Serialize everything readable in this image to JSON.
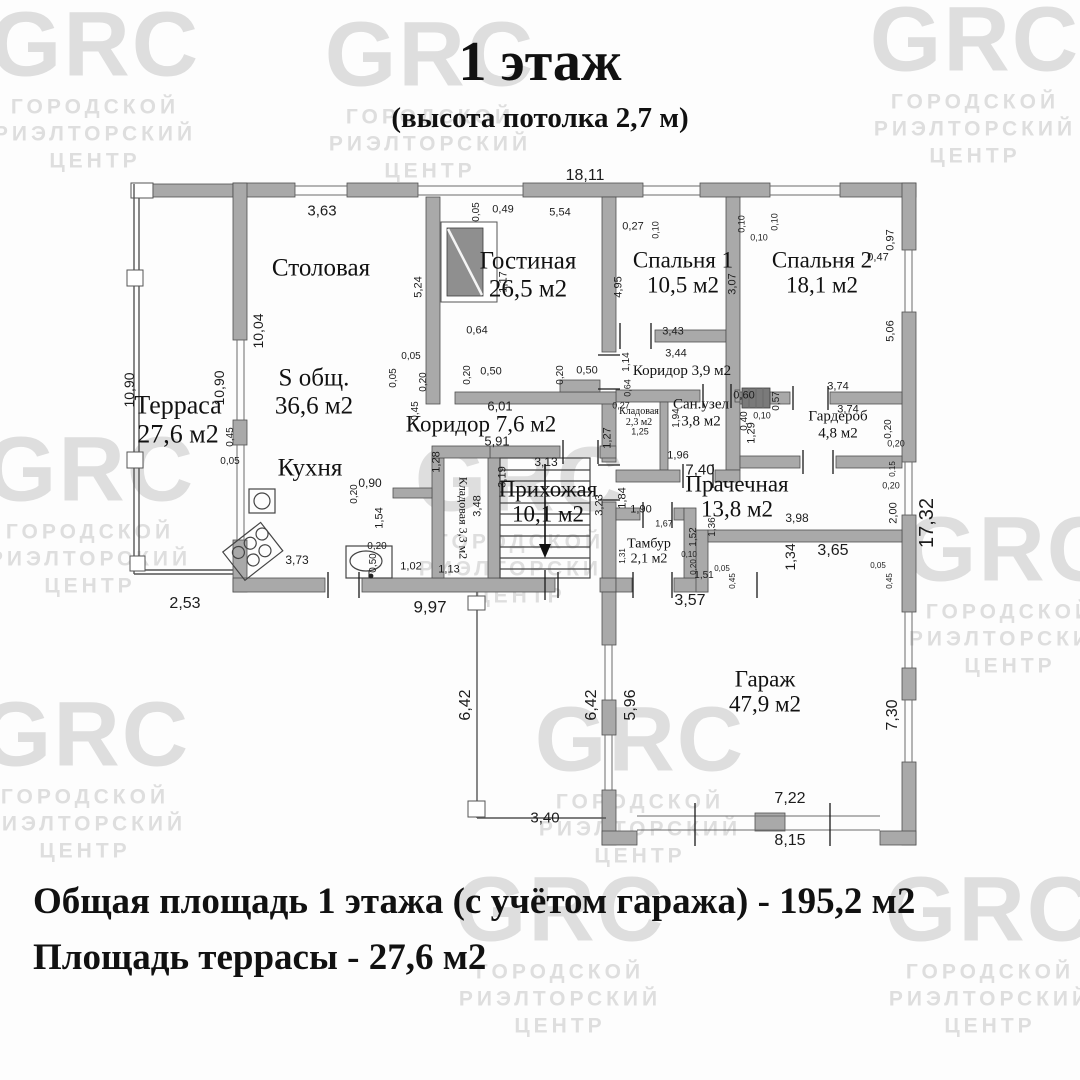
{
  "header": {
    "title": "1 этаж",
    "subtitle": "(высота потолка 2,7 м)"
  },
  "footer": {
    "line1": "Общая площадь 1 этажа (с учётом гаража) - 195,2 м2",
    "line2": "Площадь террасы - 27,6 м2"
  },
  "watermark": {
    "brand": "GRC",
    "lines": [
      "ГОРОДСКОЙ",
      "РИЭЛТОРСКИЙ",
      "ЦЕНТР"
    ],
    "positions": [
      {
        "x": 95,
        "y": 85
      },
      {
        "x": 975,
        "y": 80
      },
      {
        "x": 430,
        "y": 95
      },
      {
        "x": 90,
        "y": 510
      },
      {
        "x": 520,
        "y": 520
      },
      {
        "x": 1010,
        "y": 590
      },
      {
        "x": 85,
        "y": 775
      },
      {
        "x": 640,
        "y": 780
      },
      {
        "x": 560,
        "y": 950
      },
      {
        "x": 990,
        "y": 950
      }
    ]
  },
  "colors": {
    "wall": "#a9a9a9",
    "shaft": "#7a7a7a",
    "watermark": "#dedede",
    "ink": "#111111"
  },
  "plan": {
    "rooms": [
      {
        "name": "Терраса",
        "area": "27,6 м2",
        "x": 178,
        "y": 420,
        "fs": 26
      },
      {
        "name": "Столовая",
        "area": "",
        "x": 321,
        "y": 268,
        "fs": 25
      },
      {
        "name": "S общ.",
        "area": "36,6 м2",
        "x": 314,
        "y": 392,
        "fs": 25
      },
      {
        "name": "Гостиная",
        "area": "26,5 м2",
        "x": 528,
        "y": 275,
        "fs": 25
      },
      {
        "name": "Спальня 1",
        "area": "10,5 м2",
        "x": 683,
        "y": 273,
        "fs": 23
      },
      {
        "name": "Спальня 2",
        "area": "18,1 м2",
        "x": 822,
        "y": 273,
        "fs": 23
      },
      {
        "name": "Коридор 3,9 м2",
        "area": "",
        "x": 682,
        "y": 371,
        "fs": 15
      },
      {
        "name": "Сан.узел",
        "area": "3,8 м2",
        "x": 701,
        "y": 413,
        "fs": 15
      },
      {
        "name": "Кладовая",
        "area": "2,3 м2",
        "x": 639,
        "y": 417,
        "fs": 10
      },
      {
        "name": "Гардероб",
        "area": "4,8 м2",
        "x": 838,
        "y": 425,
        "fs": 15
      },
      {
        "name": "Коридор 7,6 м2",
        "area": "",
        "x": 481,
        "y": 424,
        "fs": 23
      },
      {
        "name": "Кухня",
        "area": "",
        "x": 310,
        "y": 468,
        "fs": 25
      },
      {
        "name": "Кладовая 3,3 м2",
        "area": "",
        "x": 463,
        "y": 518,
        "fs": 12,
        "rot": 90
      },
      {
        "name": "Прихожая",
        "area": "10,1 м2",
        "x": 548,
        "y": 502,
        "fs": 23
      },
      {
        "name": "Прачечная",
        "area": "13,8 м2",
        "x": 737,
        "y": 497,
        "fs": 23
      },
      {
        "name": "Тамбур",
        "area": "2,1 м2",
        "x": 649,
        "y": 552,
        "fs": 14
      },
      {
        "name": "Гараж",
        "area": "47,9 м2",
        "x": 765,
        "y": 692,
        "fs": 23
      }
    ],
    "dimensions": [
      {
        "t": "18,11",
        "x": 585,
        "y": 176,
        "s": 16
      },
      {
        "t": "3,63",
        "x": 322,
        "y": 211,
        "s": 15
      },
      {
        "t": "0,05",
        "x": 477,
        "y": 212,
        "r": 1,
        "s": 10
      },
      {
        "t": "0,49",
        "x": 503,
        "y": 210,
        "s": 11
      },
      {
        "t": "5,54",
        "x": 560,
        "y": 213,
        "s": 11
      },
      {
        "t": "0,27",
        "x": 633,
        "y": 227,
        "s": 11
      },
      {
        "t": "0,10",
        "x": 656,
        "y": 230,
        "r": 1,
        "s": 9
      },
      {
        "t": "0,10",
        "x": 742,
        "y": 224,
        "r": 1,
        "s": 9
      },
      {
        "t": "0,10",
        "x": 759,
        "y": 238,
        "s": 9
      },
      {
        "t": "0,10",
        "x": 775,
        "y": 222,
        "r": 1,
        "s": 9
      },
      {
        "t": "0,97",
        "x": 891,
        "y": 240,
        "r": 1,
        "s": 11
      },
      {
        "t": "0,47",
        "x": 878,
        "y": 258,
        "s": 11
      },
      {
        "t": "3,07",
        "x": 733,
        "y": 284,
        "r": 1,
        "s": 11
      },
      {
        "t": "5,06",
        "x": 891,
        "y": 331,
        "r": 1,
        "s": 11
      },
      {
        "t": "4,95",
        "x": 619,
        "y": 287,
        "r": 1,
        "s": 11
      },
      {
        "t": "5,24",
        "x": 419,
        "y": 287,
        "r": 1,
        "s": 11
      },
      {
        "t": "1,17",
        "x": 504,
        "y": 282,
        "r": 1,
        "s": 11
      },
      {
        "t": "0,64",
        "x": 477,
        "y": 331,
        "s": 11
      },
      {
        "t": "10,04",
        "x": 258,
        "y": 331,
        "r": 1,
        "s": 14
      },
      {
        "t": "10,90",
        "x": 219,
        "y": 388,
        "r": 1,
        "s": 14
      },
      {
        "t": "10,90",
        "x": 129,
        "y": 390,
        "r": 1,
        "s": 14
      },
      {
        "t": "0,05",
        "x": 411,
        "y": 357,
        "s": 10
      },
      {
        "t": "0,05",
        "x": 394,
        "y": 378,
        "r": 1,
        "s": 10
      },
      {
        "t": "0,20",
        "x": 424,
        "y": 382,
        "r": 1,
        "s": 10
      },
      {
        "t": "0,45",
        "x": 416,
        "y": 411,
        "r": 1,
        "s": 10
      },
      {
        "t": "0,20",
        "x": 468,
        "y": 375,
        "r": 1,
        "s": 10
      },
      {
        "t": "0,50",
        "x": 491,
        "y": 372,
        "s": 11
      },
      {
        "t": "0,20",
        "x": 561,
        "y": 375,
        "r": 1,
        "s": 10
      },
      {
        "t": "0,50",
        "x": 587,
        "y": 371,
        "s": 11
      },
      {
        "t": "0,45",
        "x": 231,
        "y": 437,
        "r": 1,
        "s": 10
      },
      {
        "t": "0,05",
        "x": 230,
        "y": 462,
        "s": 10
      },
      {
        "t": "6,01",
        "x": 500,
        "y": 406,
        "s": 13
      },
      {
        "t": "5,91",
        "x": 497,
        "y": 441,
        "s": 13
      },
      {
        "t": "1,28",
        "x": 437,
        "y": 462,
        "r": 1,
        "s": 11
      },
      {
        "t": "3,19",
        "x": 503,
        "y": 477,
        "r": 1,
        "s": 11
      },
      {
        "t": "3,48",
        "x": 478,
        "y": 506,
        "r": 1,
        "s": 11
      },
      {
        "t": "0,90",
        "x": 370,
        "y": 483,
        "s": 12
      },
      {
        "t": "0,20",
        "x": 355,
        "y": 494,
        "r": 1,
        "s": 10
      },
      {
        "t": "1,54",
        "x": 380,
        "y": 518,
        "r": 1,
        "s": 11
      },
      {
        "t": "0,20",
        "x": 377,
        "y": 547,
        "s": 10
      },
      {
        "t": "0,50",
        "x": 374,
        "y": 563,
        "r": 1,
        "s": 10
      },
      {
        "t": "1,02",
        "x": 411,
        "y": 567,
        "s": 11
      },
      {
        "t": "1,13",
        "x": 449,
        "y": 570,
        "s": 11
      },
      {
        "t": "3,73",
        "x": 297,
        "y": 560,
        "s": 12
      },
      {
        "t": "2,53",
        "x": 185,
        "y": 604,
        "s": 16
      },
      {
        "t": "9,97",
        "x": 430,
        "y": 607,
        "s": 17
      },
      {
        "t": "3,43",
        "x": 673,
        "y": 332,
        "s": 11
      },
      {
        "t": "3,44",
        "x": 676,
        "y": 354,
        "s": 11
      },
      {
        "t": "1,14",
        "x": 627,
        "y": 362,
        "r": 1,
        "s": 10
      },
      {
        "t": "0,60",
        "x": 744,
        "y": 396,
        "s": 11
      },
      {
        "t": "0,57",
        "x": 777,
        "y": 401,
        "r": 1,
        "s": 10
      },
      {
        "t": "3,74",
        "x": 838,
        "y": 387,
        "s": 11
      },
      {
        "t": "3,74",
        "x": 848,
        "y": 410,
        "s": 11
      },
      {
        "t": "0,40",
        "x": 745,
        "y": 421,
        "r": 1,
        "s": 10
      },
      {
        "t": "0,10",
        "x": 762,
        "y": 416,
        "s": 9
      },
      {
        "t": "1,29",
        "x": 752,
        "y": 433,
        "r": 1,
        "s": 11
      },
      {
        "t": "0,20",
        "x": 889,
        "y": 429,
        "r": 1,
        "s": 10
      },
      {
        "t": "0,20",
        "x": 896,
        "y": 444,
        "s": 9
      },
      {
        "t": "1,94",
        "x": 677,
        "y": 418,
        "r": 1,
        "s": 10
      },
      {
        "t": "0,27",
        "x": 621,
        "y": 406,
        "s": 9
      },
      {
        "t": "0,64",
        "x": 628,
        "y": 388,
        "r": 1,
        "s": 9
      },
      {
        "t": "1,25",
        "x": 640,
        "y": 432,
        "s": 9
      },
      {
        "t": "1,96",
        "x": 678,
        "y": 456,
        "s": 11
      },
      {
        "t": "1,27",
        "x": 608,
        "y": 438,
        "r": 1,
        "s": 11
      },
      {
        "t": "7,40",
        "x": 700,
        "y": 470,
        "s": 15
      },
      {
        "t": "1,84",
        "x": 623,
        "y": 498,
        "r": 1,
        "s": 11
      },
      {
        "t": "3,98",
        "x": 797,
        "y": 518,
        "s": 12
      },
      {
        "t": "2,00",
        "x": 894,
        "y": 513,
        "r": 1,
        "s": 11
      },
      {
        "t": "0,15",
        "x": 893,
        "y": 469,
        "r": 1,
        "s": 8
      },
      {
        "t": "0,20",
        "x": 891,
        "y": 486,
        "s": 9
      },
      {
        "t": "17,32",
        "x": 927,
        "y": 523,
        "r": 1,
        "s": 20
      },
      {
        "t": "3,13",
        "x": 546,
        "y": 462,
        "s": 12
      },
      {
        "t": "3,23",
        "x": 600,
        "y": 505,
        "r": 1,
        "s": 11
      },
      {
        "t": "1,90",
        "x": 641,
        "y": 510,
        "s": 11
      },
      {
        "t": "1,67",
        "x": 664,
        "y": 524,
        "s": 9
      },
      {
        "t": "1,52",
        "x": 694,
        "y": 537,
        "r": 1,
        "s": 10
      },
      {
        "t": "1,36",
        "x": 713,
        "y": 527,
        "r": 1,
        "s": 10
      },
      {
        "t": "1,31",
        "x": 623,
        "y": 556,
        "r": 1,
        "s": 8
      },
      {
        "t": "1,51",
        "x": 704,
        "y": 576,
        "s": 10
      },
      {
        "t": "0,10",
        "x": 689,
        "y": 555,
        "s": 8
      },
      {
        "t": "0,20",
        "x": 694,
        "y": 567,
        "r": 1,
        "s": 8
      },
      {
        "t": "0,05",
        "x": 722,
        "y": 569,
        "s": 8
      },
      {
        "t": "0,45",
        "x": 733,
        "y": 581,
        "r": 1,
        "s": 8
      },
      {
        "t": "3,57",
        "x": 690,
        "y": 601,
        "s": 16
      },
      {
        "t": "1,34",
        "x": 790,
        "y": 557,
        "r": 1,
        "s": 14
      },
      {
        "t": "3,65",
        "x": 833,
        "y": 551,
        "s": 16
      },
      {
        "t": "0,05",
        "x": 878,
        "y": 566,
        "s": 8
      },
      {
        "t": "0,45",
        "x": 890,
        "y": 581,
        "r": 1,
        "s": 8
      },
      {
        "t": "6,42",
        "x": 466,
        "y": 705,
        "r": 1,
        "s": 16
      },
      {
        "t": "3,40",
        "x": 545,
        "y": 818,
        "s": 15
      },
      {
        "t": "6,42",
        "x": 592,
        "y": 705,
        "r": 1,
        "s": 16
      },
      {
        "t": "5,96",
        "x": 631,
        "y": 705,
        "r": 1,
        "s": 16
      },
      {
        "t": "7,30",
        "x": 893,
        "y": 715,
        "r": 1,
        "s": 16
      },
      {
        "t": "7,22",
        "x": 790,
        "y": 799,
        "s": 16
      },
      {
        "t": "8,15",
        "x": 790,
        "y": 841,
        "s": 16
      }
    ]
  }
}
